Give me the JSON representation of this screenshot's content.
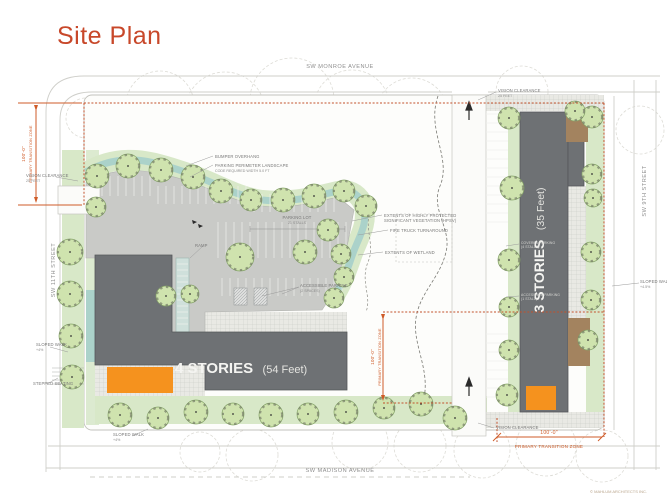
{
  "title": "Site Plan",
  "copyright": "© MAHLUM ARCHITECTS INC.",
  "streets": {
    "north": "SW MONROE AVENUE",
    "west": "SW 11TH STREET",
    "east": "SW 9TH STREET",
    "south": "SW MADISON AVENUE"
  },
  "buildings": {
    "west": {
      "stories": "4 STORIES",
      "height": "(54 Feet)"
    },
    "east": {
      "stories": "3 STORIES",
      "height": "(35 Feet)"
    }
  },
  "dimensions": {
    "west_zone": {
      "value": "100'-0\"",
      "label": "PRIMARY TRANSITION ZONE"
    },
    "mid_zone": {
      "value": "100'-0\"",
      "label": "PRIMARY TRANSITION ZONE"
    },
    "south_zone": {
      "value": "100'-0\"",
      "label": "PRIMARY TRANSITION ZONE"
    }
  },
  "annotations": {
    "bumper_overhang": "BUMPER OVERHANG",
    "perimeter_landscape_1": "PARKING PERIMETER LANDSCAPE",
    "perimeter_landscape_2": "CODE REQUIRED WIDTH 5.0 FT",
    "parking_lot_1": "PARKING LOT",
    "parking_lot_2": "21 STALLS",
    "hpsv_1": "EXTENTS OF HIGHLY PROTECTED",
    "hpsv_2": "SIGNIFICANT VEGETATION (HPSV)",
    "fire_truck": "FIRE TRUCK TURNAROUND",
    "wetland": "EXTENTS OF WETLAND",
    "accessible_1": "ACCESSIBLE PARKING",
    "accessible_2": "(2 SPACES)",
    "ramp": "RAMP",
    "vision_clearance": "VISION CLEARANCE",
    "vision_clearance_sub": "25 FEET",
    "sloped_walk": "SLOPED WALK",
    "sloped_walk_pct": "+4%",
    "sloped_walk_pct_e": "+4.5%",
    "stepped_seating": "STEPPED SEATING",
    "covered_1": "COVERED PARKING",
    "covered_2": "(4 STALLS)",
    "accessible_e_1": "ACCESSIBLE PARKING",
    "accessible_e_2": "(1 STALL)"
  },
  "colors": {
    "accent_orange": "#c8482a",
    "zone_orange": "#cf5b28",
    "building_gray": "#6e7174",
    "entry_orange": "#f5921e",
    "tree_green": "#cfe3ae",
    "lawn_green": "#d8e8c8",
    "swale_teal": "#abd2ca",
    "asphalt_gray": "#c9cac7"
  }
}
